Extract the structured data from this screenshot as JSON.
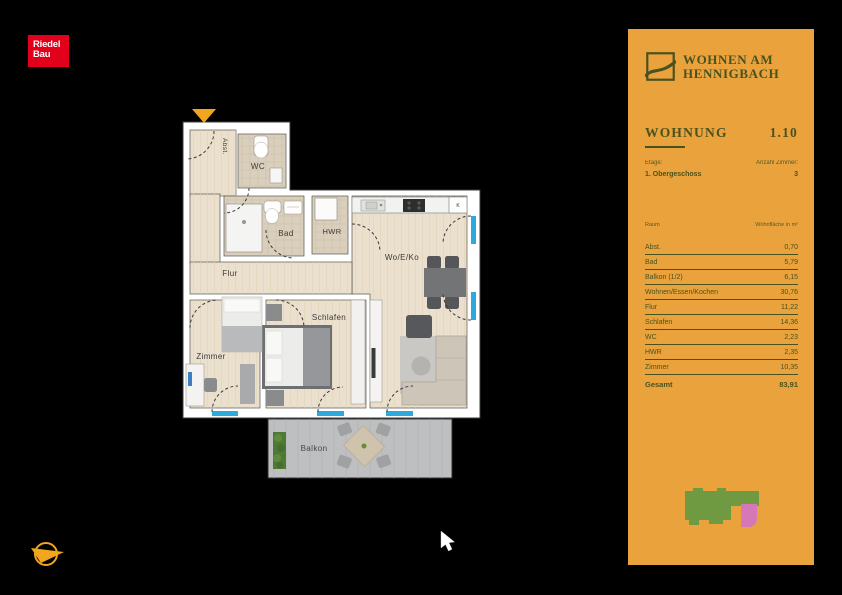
{
  "branding": {
    "riedel": {
      "line1": "Riedel",
      "line2": "Bau"
    },
    "project": {
      "line1": "WOHNEN AM",
      "line2": "HENNIGBACH"
    }
  },
  "panel": {
    "unit_label": "WOHNUNG",
    "unit_number": "1.10",
    "etage_label": "Etage:",
    "etage_value": "1. Obergeschoss",
    "rooms_label": "Anzahl Zimmer:",
    "rooms_value": "3",
    "table": {
      "col_room": "Raum",
      "col_area": "Wohnfläche in m²",
      "rows": [
        {
          "room": "Abst.",
          "area": "0,70"
        },
        {
          "room": "Bad",
          "area": "5,79"
        },
        {
          "room": "Balkon (1/2)",
          "area": "6,15"
        },
        {
          "room": "Wohnen/Essen/Kochen",
          "area": "30,76"
        },
        {
          "room": "Flur",
          "area": "11,22"
        },
        {
          "room": "Schlafen",
          "area": "14,36"
        },
        {
          "room": "WC",
          "area": "2,23"
        },
        {
          "room": "HWR",
          "area": "2,35"
        },
        {
          "room": "Zimmer",
          "area": "10,35"
        }
      ],
      "total_label": "Gesamt",
      "total_area": "83,91"
    }
  },
  "floorplan": {
    "labels": {
      "abst": "Abst.",
      "wc": "WC",
      "bad": "Bad",
      "hwr": "HWR",
      "woeko": "Wo/E/Ko",
      "flur": "Flur",
      "zimmer": "Zimmer",
      "schlafen": "Schlafen",
      "balkon": "Balkon",
      "fridge": "K"
    }
  },
  "colors": {
    "panel_bg": "#eaa23c",
    "panel_text": "#49521f",
    "riedel_red": "#e2001a",
    "window_blue": "#2fa8dc",
    "accent_orange": "#f2a51e",
    "wood_floor": "#ebe0cd",
    "tile_floor": "#d9cfbc",
    "balcony_floor": "#bdbfc1",
    "minimap_green": "#6f9a41",
    "minimap_pink": "#d678b8"
  }
}
